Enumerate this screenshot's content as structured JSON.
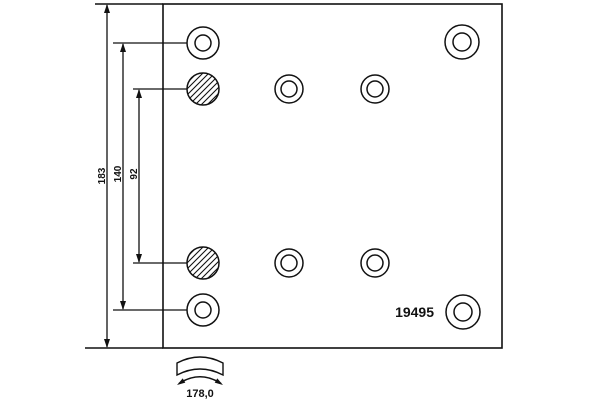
{
  "page": {
    "background": "#ffffff",
    "line_color": "#111111"
  },
  "drawing": {
    "part_number": "19495",
    "dimensions": {
      "overall_height": "183",
      "outer_hole_spacing": "140",
      "inner_hole_spacing": "92",
      "lining_width": "178,0"
    },
    "holes": {
      "ring_hole_count": 8,
      "hatched_hole_count": 2
    }
  }
}
